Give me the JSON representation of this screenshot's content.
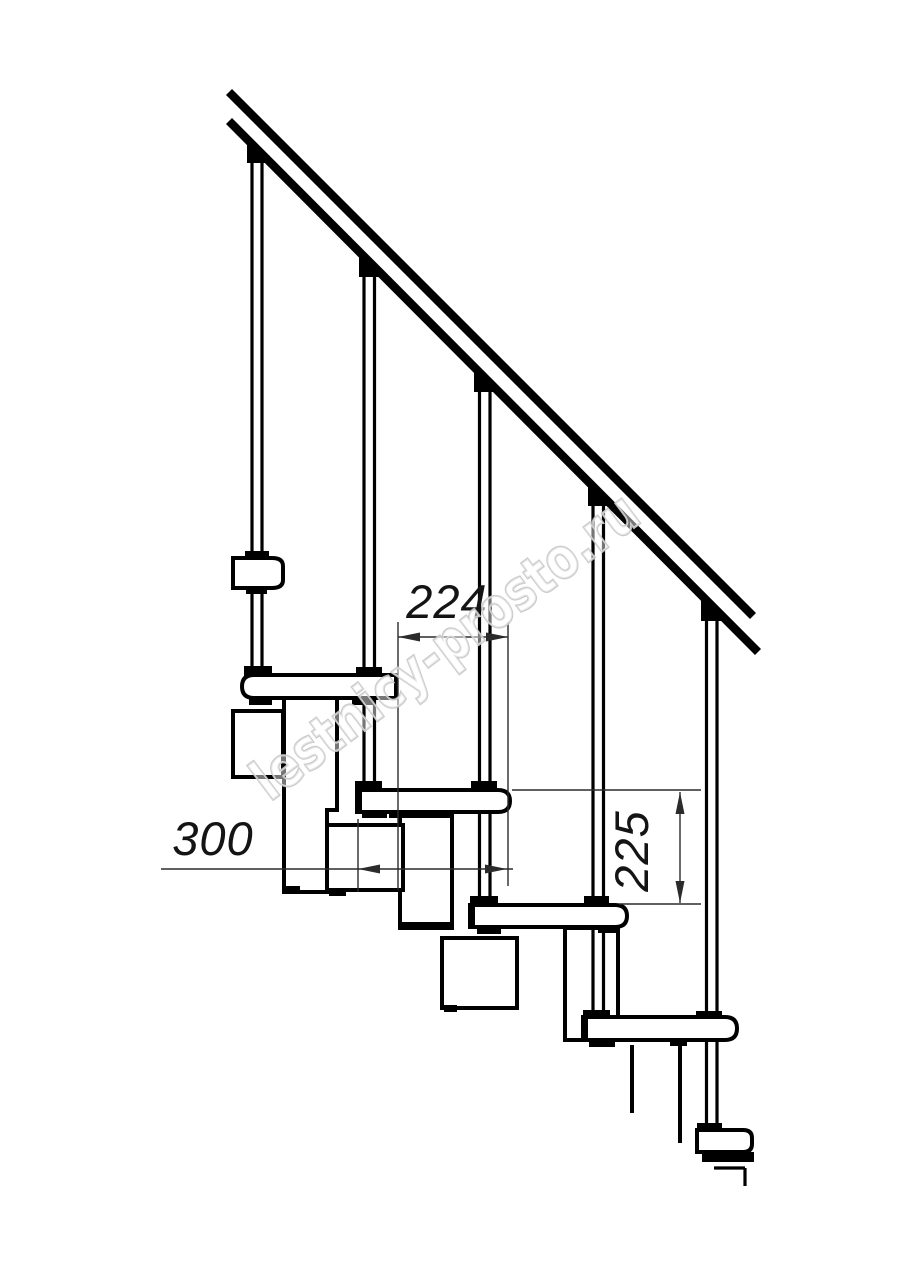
{
  "drawing": {
    "dimensions": {
      "step_run": {
        "value": "224"
      },
      "tread_depth": {
        "value": "300"
      },
      "step_rise": {
        "value": "225"
      }
    },
    "watermark": {
      "text": "lestnicy-prosto.ru"
    },
    "colors": {
      "background": "#ffffff",
      "line": "#000000",
      "dim_line": "#2b2b2b",
      "watermark_stroke": "#c6c6c6"
    }
  }
}
